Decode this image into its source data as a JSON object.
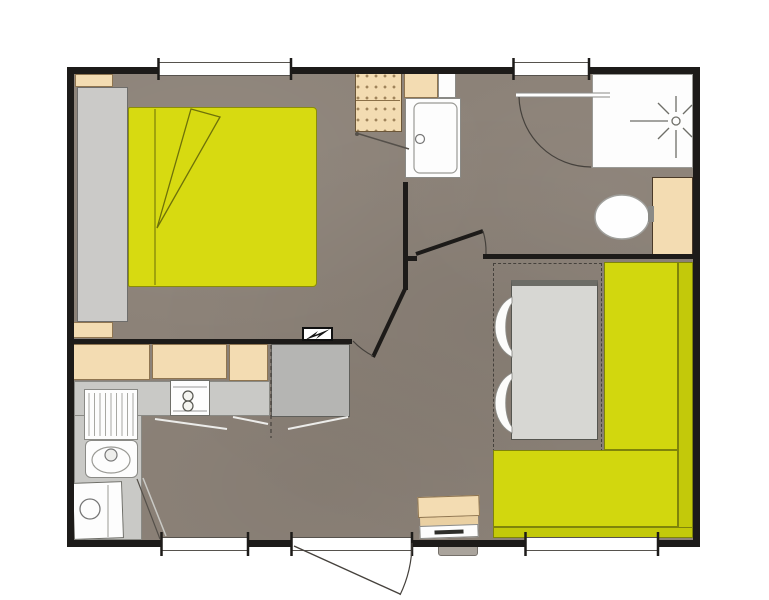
{
  "palette": {
    "bg": "#ffffff",
    "wall": "#1d1b19",
    "floor": "#8c8278",
    "accent-yellow": "#d7da11",
    "bench-seat": "#d2d70e",
    "bench-back": "#c3c90a",
    "beige": "#f3dcb2",
    "beige-border": "#8f7550",
    "gray-furniture": "#cbcac8",
    "counter": "#c9c9c6",
    "tall-unit": "#b5b5b3",
    "table": "#d7d7d3",
    "white-fixture": "#fdfdfd",
    "line-dark": "#45413c",
    "line-light": "#9a9a96"
  },
  "plan": {
    "type": "mobile-home-floor-plan",
    "rooms": [
      {
        "name": "bedroom",
        "fixtures": [
          "double-bed",
          "wardrobe",
          "corner-shelf",
          "nightstand",
          "hanging-closet"
        ]
      },
      {
        "name": "bathroom",
        "fixtures": [
          "washbasin",
          "vanity-cabinet",
          "shower",
          "toilet",
          "storage-cabinet",
          "exterior-door"
        ]
      },
      {
        "name": "kitchen",
        "fixtures": [
          "wall-cabinet",
          "wall-cabinet",
          "wall-cabinet",
          "worktop",
          "two-burner-hob",
          "sink-with-drainer",
          "appliance",
          "tall-cabinet",
          "electrical-panel"
        ]
      },
      {
        "name": "living-dining",
        "fixtures": [
          "l-shaped-bench",
          "dining-table",
          "chair",
          "chair",
          "heater",
          "entrance-door",
          "convertible-dining-zone"
        ]
      }
    ],
    "openings": [
      "top-window",
      "bathroom-entry-door",
      "bottom-window-left",
      "entrance-door",
      "bottom-window-right"
    ]
  }
}
